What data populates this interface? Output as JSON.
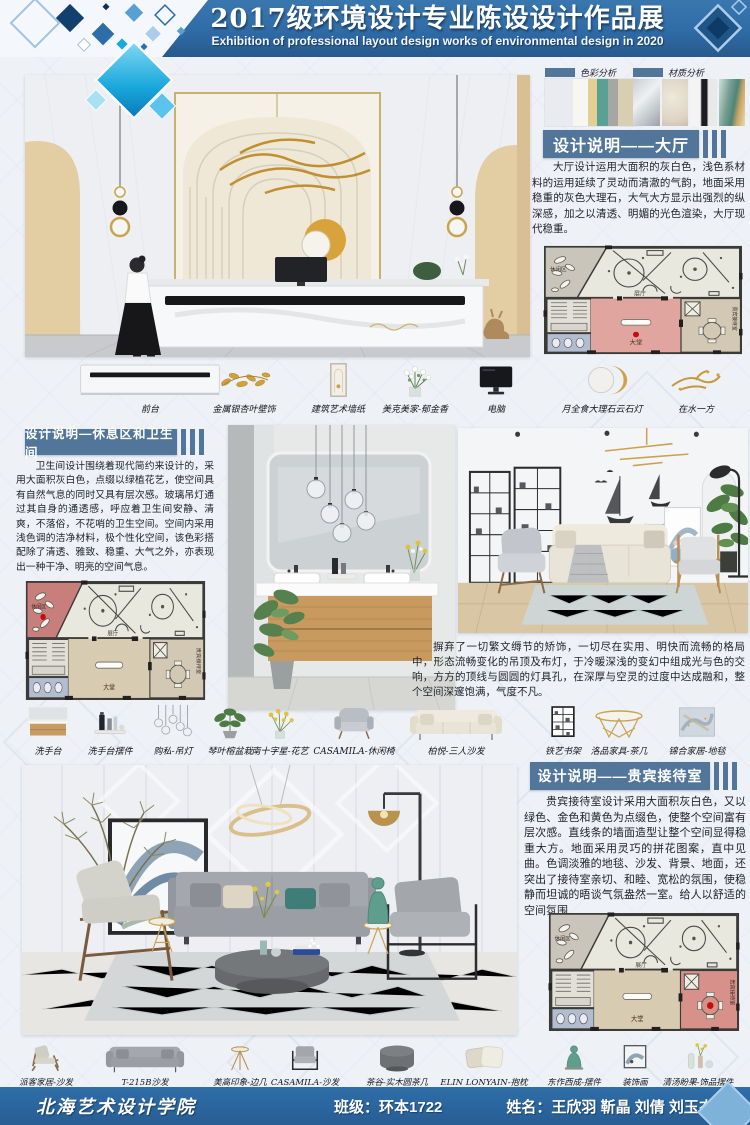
{
  "header": {
    "title": "2017级环境设计专业陈设设计作品展",
    "subtitle": "Exhibition of professional layout design works of environmental design in 2020"
  },
  "analysis": {
    "color_label": "色彩分析",
    "material_label": "材质分析",
    "color_swatches": [
      "#e9ebf1",
      "#f7f6f2",
      "#e3cf96",
      "#58a193",
      "#a6a6a4",
      "#d9cdb2"
    ]
  },
  "sections": {
    "hall": {
      "title": "设计说明——大厅",
      "body": "大厅设计运用大面积的灰白色，浅色系材料的运用延续了灵动而清澈的气韵，地面采用稳重的灰色大理石，大气大方显示出强烈的纵深感，加之以清透、明媚的光色渲染，大厅现代稳重。"
    },
    "rest": {
      "title": "设计说明—休息区和卫生间",
      "body": "卫生间设计围绕着现代简约来设计的，采用大面积灰白色，点缀以绿植花艺，使空间具有自然气息的同时又具有层次感。玻璃吊灯通过其自身的通透感，呼应着卫生间安静、清爽，不落俗，不花哨的卫生空间。空间内采用浅色调的洁净材料，极个性化空间，该色彩搭配除了清透、雅致、稳重、大气之外，亦表现出一种干净、明亮的空间气息。"
    },
    "living_note": "摒弃了一切繁文缛节的矫饰，一切尽在实用、明快而流畅的格局中，形态流畅变化的吊顶及布灯，于冷暖深浅的变幻中组成光与色的交响，方方的顶线与圆圆的灯具孔，在深厚与空灵的过度中达成融和，整个空间深邃饱满，气度不凡。",
    "vip": {
      "title": "设计说明——贵宾接待室",
      "body": "贵宾接待室设计采用大面积灰白色，又以绿色、金色和黄色为点缀色，使整个空间富有层次感。直线条的墙面造型让整个空间显得稳重大方。地面采用灵巧的拼花图案，直中见曲。色调淡雅的地毯、沙发、背景、地面，还突出了接待室亲切、和睦、宽松的氛围，使稳静而坦诚的晤谈气氛盎然一室。给人以舒适的空间氛围"
    }
  },
  "floorplan": {
    "rooms": {
      "leisure": "休闲区",
      "exhibition": "展厅",
      "hall": "大堂",
      "vip": "贵宾接待室"
    },
    "highlight_dot": "#c40d0d",
    "hall_highlight": "#e0a59f",
    "leisure_highlight": "#c87e7a",
    "vip_highlight": "#d8918a"
  },
  "items_row1": [
    "前台",
    "金属银杏叶壁饰",
    "建筑艺术墙纸",
    "美克美家-郁金香",
    "电脑",
    "月全食大理石云石灯",
    "在水一方"
  ],
  "items_row2": [
    "洗手台",
    "洗手台摆件",
    "购私-吊灯",
    "琴叶榕盆栽",
    "南十字星-花艺",
    "CASAMILA-休闲椅",
    "柏悦-三人沙发",
    "铁艺书架",
    "洛品家具-茶几",
    "锦合家居-地毯"
  ],
  "items_row3": [
    "派客家居-沙发",
    "T-215B沙发",
    "美高印象-边几",
    "CASAMILA-沙发",
    "茶谷-实木圆茶几",
    "ELIN LONYAIN-抱枕",
    "东作西成-摆件",
    "装饰画",
    "清汤盼果-饰品摆件"
  ],
  "footer": {
    "school": "北海艺术设计学院",
    "class_label": "班级：",
    "class_value": "环本1722",
    "name_label": "姓名：",
    "name_value": "王欣羽 靳晶 刘倩 刘玉杰"
  },
  "colors": {
    "header_blue": "#2f6ba6",
    "banner_blue": "#527699",
    "footer_blue": "#2f6ea9"
  }
}
